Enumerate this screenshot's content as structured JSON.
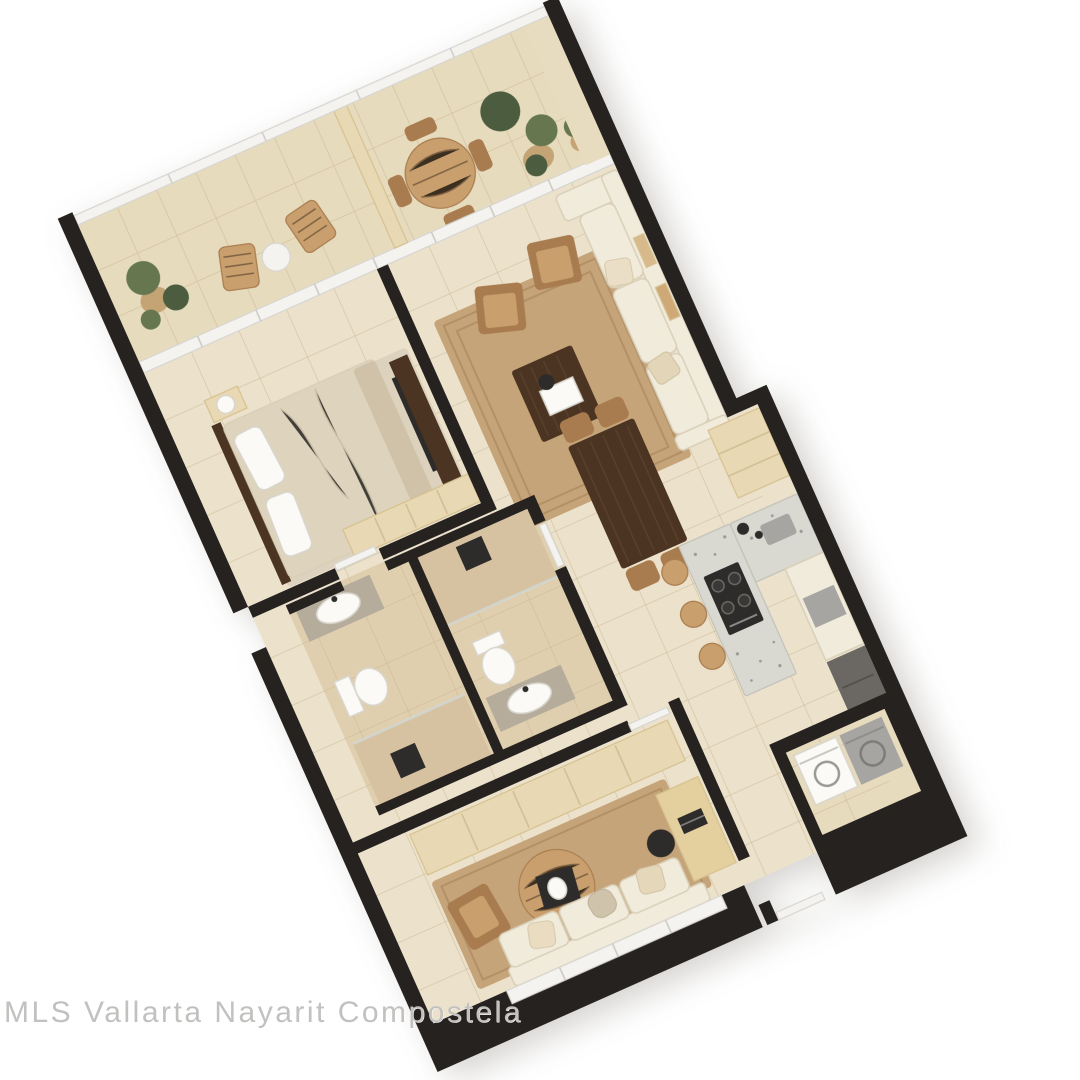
{
  "watermark": {
    "text": "MLS Vallarta Nayarit Compostela"
  },
  "colors": {
    "wall": "#262220",
    "black": "#2e2c2a",
    "floor": "#ece2cc",
    "terrace": "#e7dbbe",
    "bathFloor": "#e0cfae",
    "rug": "#c5a479",
    "rugLine": "#a9865c",
    "bedRug": "#ddd2bd",
    "cream": "#f1ebdc",
    "creamEdge": "#d9cfb8",
    "woodLight": "#e9d8b4",
    "woodLightEdge": "#d5c18e",
    "woodMid": "#c89f6d",
    "woodTan": "#a97c4f",
    "walnut": "#4b3422",
    "fixture": "#fbfaf6",
    "fixtureEdge": "#d8d5cc",
    "stone": "#b5ac9c",
    "counter": "#d9d8d1",
    "counterEdge": "#c2c1b9",
    "steel": "#a7a5a1",
    "appliance": "#6b6864",
    "glass": "#f4f3ef",
    "glassEdge": "#d6d5d0",
    "plant": "#66774f",
    "plantDark": "#4c5c3e",
    "basket": "#c4a474",
    "tileLine": "#c8b28c",
    "watermark": "#c2c1bf"
  }
}
